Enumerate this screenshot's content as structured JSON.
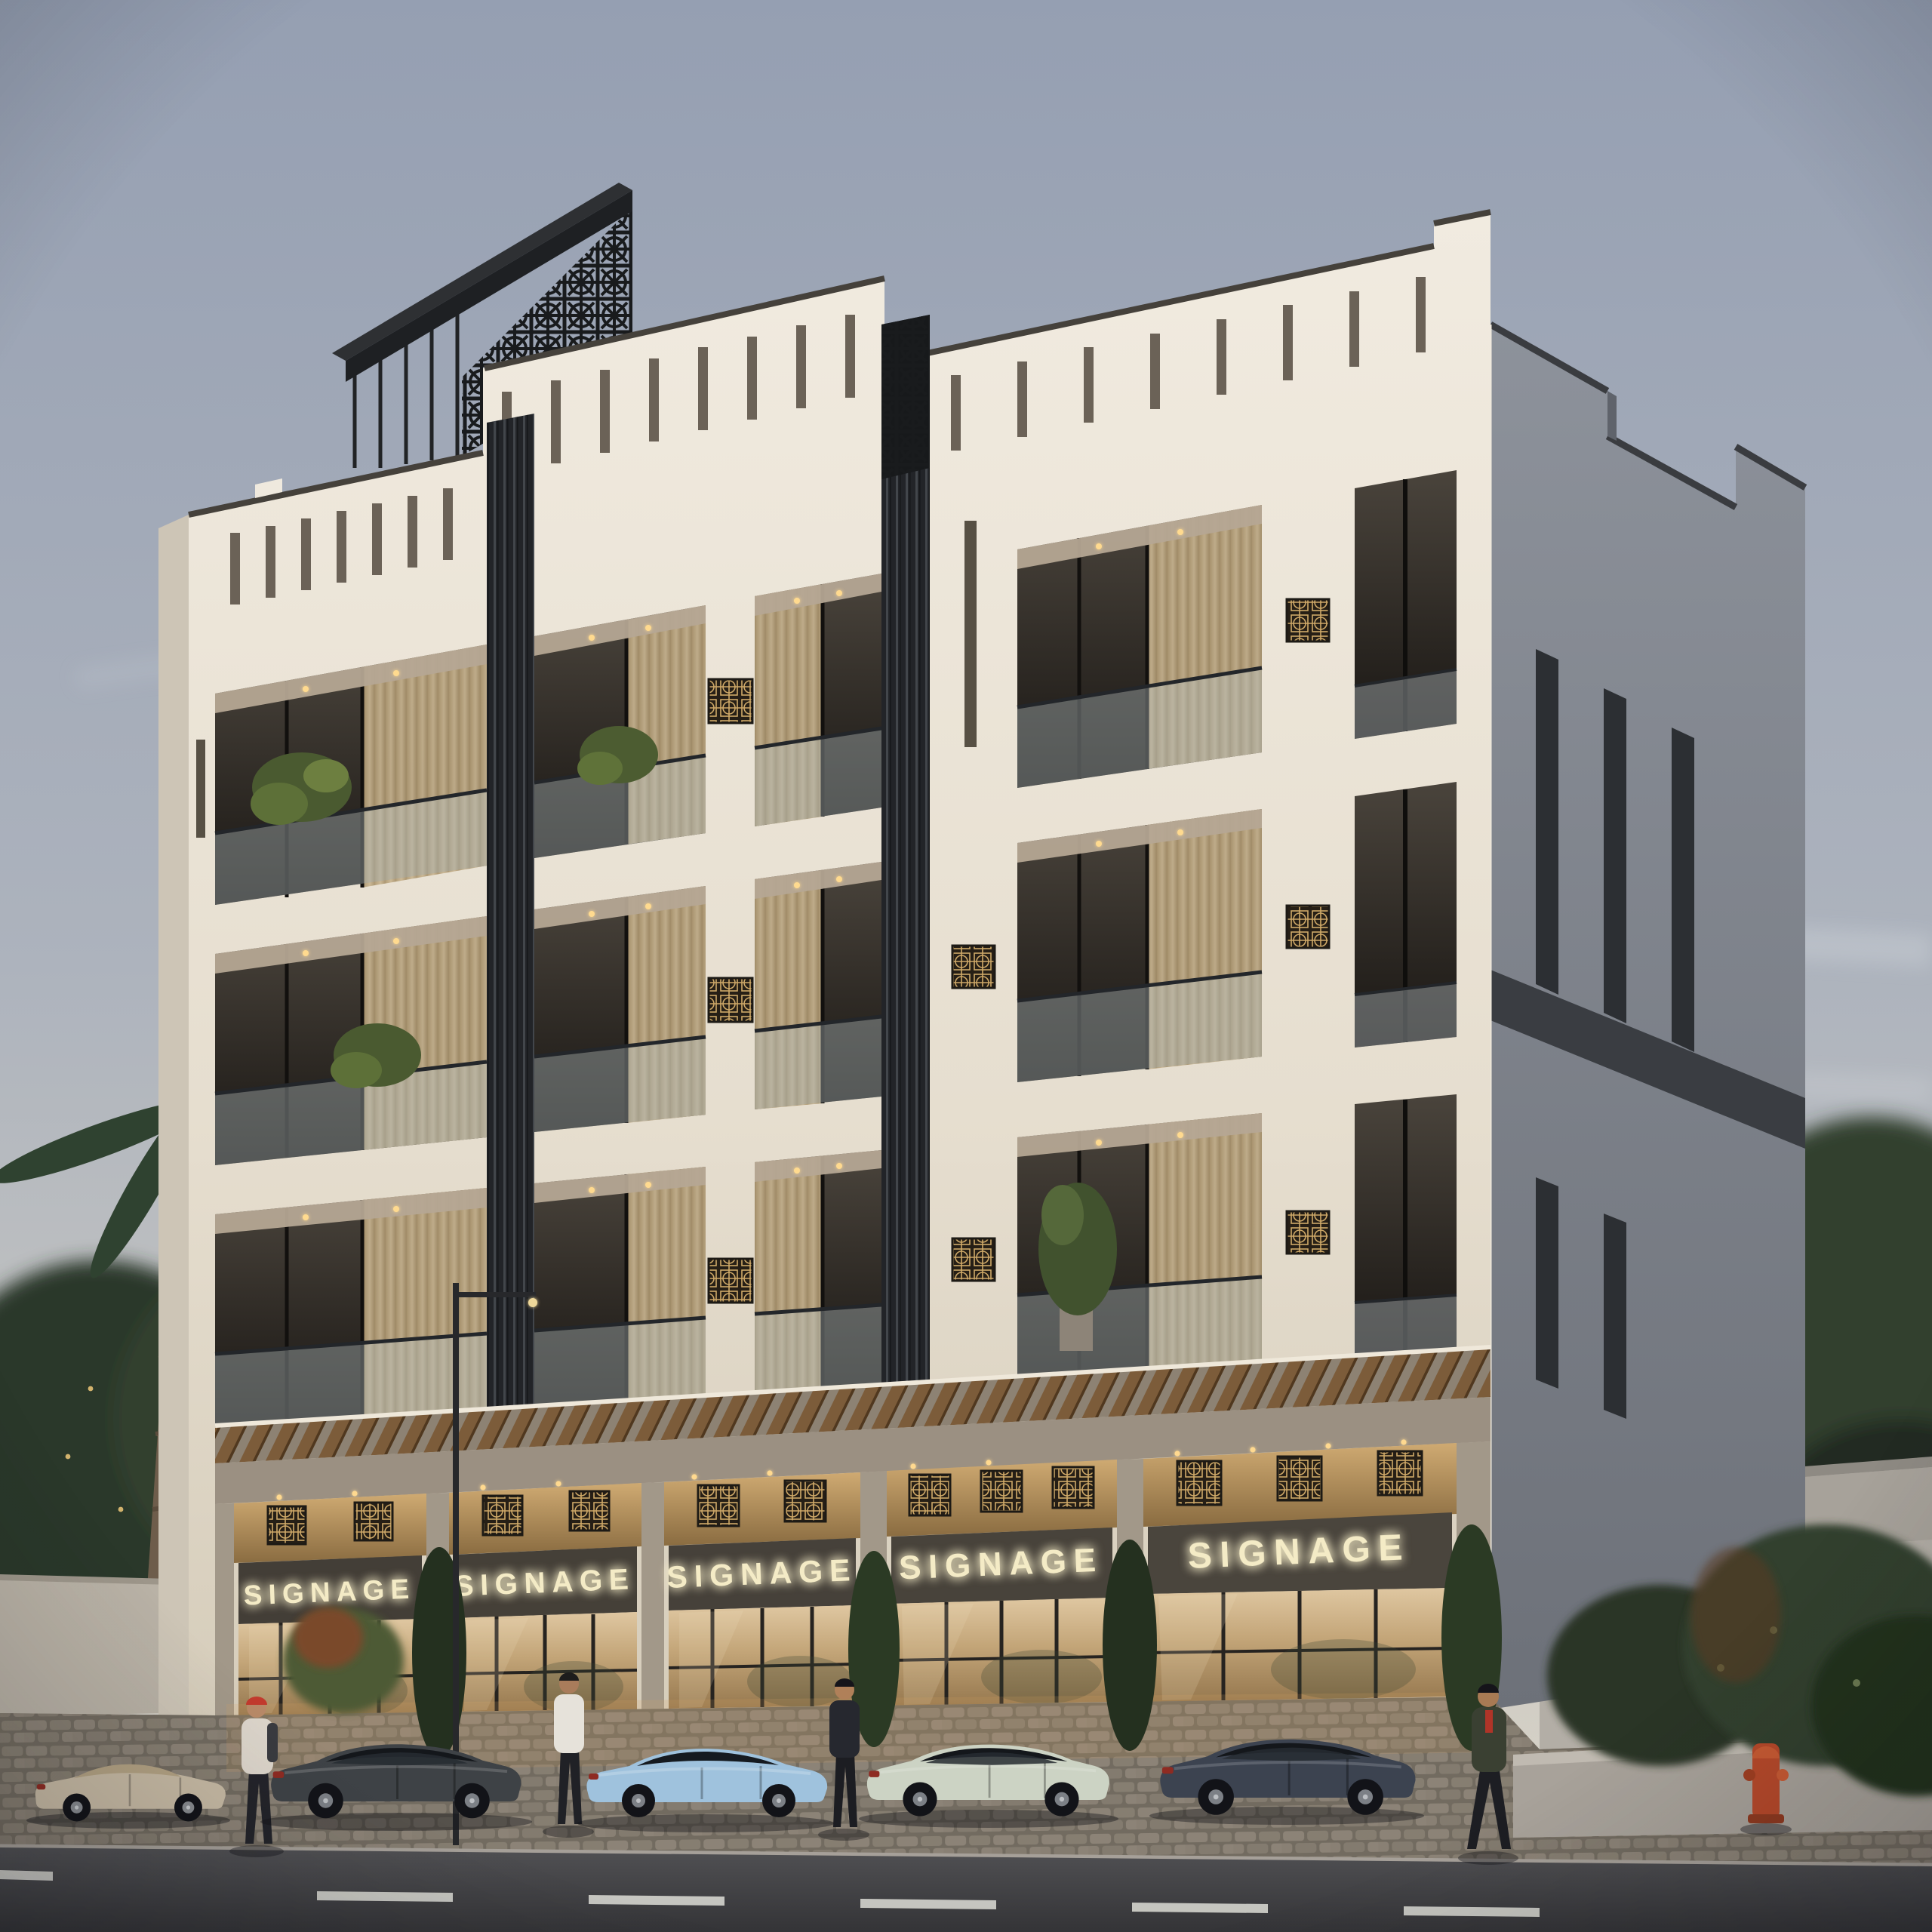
{
  "scene": {
    "setting": "dusk exterior render of a modern mixed-use building",
    "sky": {
      "top": "#959fb2",
      "mid": "#adb3bd",
      "horizon": "#ded7c8"
    }
  },
  "building": {
    "type": "retail ground floor with 3 residential floors",
    "floors_above_retail": 3,
    "facade_front_color": "#eae4d8",
    "facade_side_color": "#7d828b",
    "screen_color": "#1f2124",
    "wood_color": "#84613e",
    "storefronts": [
      {
        "label": "SIGNAGE"
      },
      {
        "label": "SIGNAGE"
      },
      {
        "label": "SIGNAGE"
      },
      {
        "label": "SIGNAGE"
      },
      {
        "label": "SIGNAGE"
      }
    ],
    "signage_text_color": "#f4ebc6"
  },
  "street": {
    "road_color": "#47474a",
    "sidewalk_color": "#837b6f",
    "lane_marking_color": "#d8d8d2",
    "hydrant_color": "#b7492a",
    "cars": [
      {
        "type": "convertible",
        "color": "#c7baa4"
      },
      {
        "type": "sedan",
        "color": "#3e4246"
      },
      {
        "type": "coupe",
        "color": "#9fc2dd"
      },
      {
        "type": "sedan",
        "color": "#ccd3c4"
      },
      {
        "type": "sedan",
        "color": "#3c4350"
      }
    ],
    "people": [
      {
        "desc": "standing, red beanie, light jacket"
      },
      {
        "desc": "standing, white shirt"
      },
      {
        "desc": "standing, dark jacket"
      },
      {
        "desc": "walking, dark green jacket"
      }
    ]
  }
}
